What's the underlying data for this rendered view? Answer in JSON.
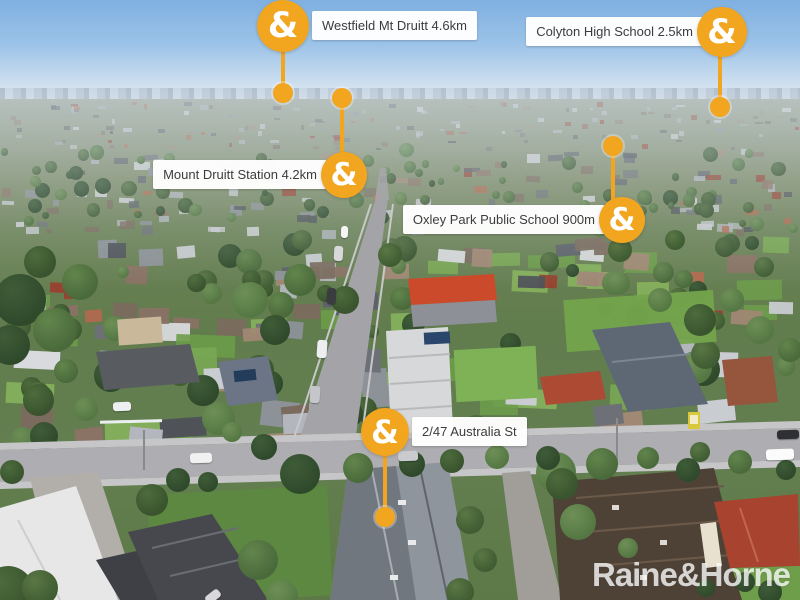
{
  "image_type": "aerial-property-marketing-photo",
  "brand": {
    "name": "Raine & Horne",
    "watermark": "Raine&Horne",
    "badge_glyph": "&",
    "accent_orange": "#F2A51F"
  },
  "markers": [
    {
      "id": "westfield-mt-druitt",
      "label": "Westfield Mt Druitt 4.6km",
      "side": "right",
      "badge": {
        "x": 283,
        "y": 26,
        "r": 26
      },
      "dot": {
        "x": 283,
        "y": 93
      }
    },
    {
      "id": "colyton-high-school",
      "label": "Colyton High School 2.5km",
      "side": "left",
      "badge": {
        "x": 722,
        "y": 32,
        "r": 25
      },
      "dot": {
        "x": 720,
        "y": 107
      }
    },
    {
      "id": "mount-druitt-station",
      "label": "Mount Druitt Station 4.2km",
      "side": "left",
      "badge": {
        "x": 344,
        "y": 175,
        "r": 23
      },
      "dot": {
        "x": 342,
        "y": 98
      }
    },
    {
      "id": "oxley-park-public-school",
      "label": "Oxley Park Public School 900m",
      "side": "left",
      "badge": {
        "x": 622,
        "y": 220,
        "r": 23
      },
      "dot": {
        "x": 613,
        "y": 146
      }
    },
    {
      "id": "property-address",
      "label": "2/47 Australia St",
      "side": "right",
      "badge": {
        "x": 385,
        "y": 432,
        "r": 24
      },
      "dot": {
        "x": 385,
        "y": 517
      }
    }
  ]
}
